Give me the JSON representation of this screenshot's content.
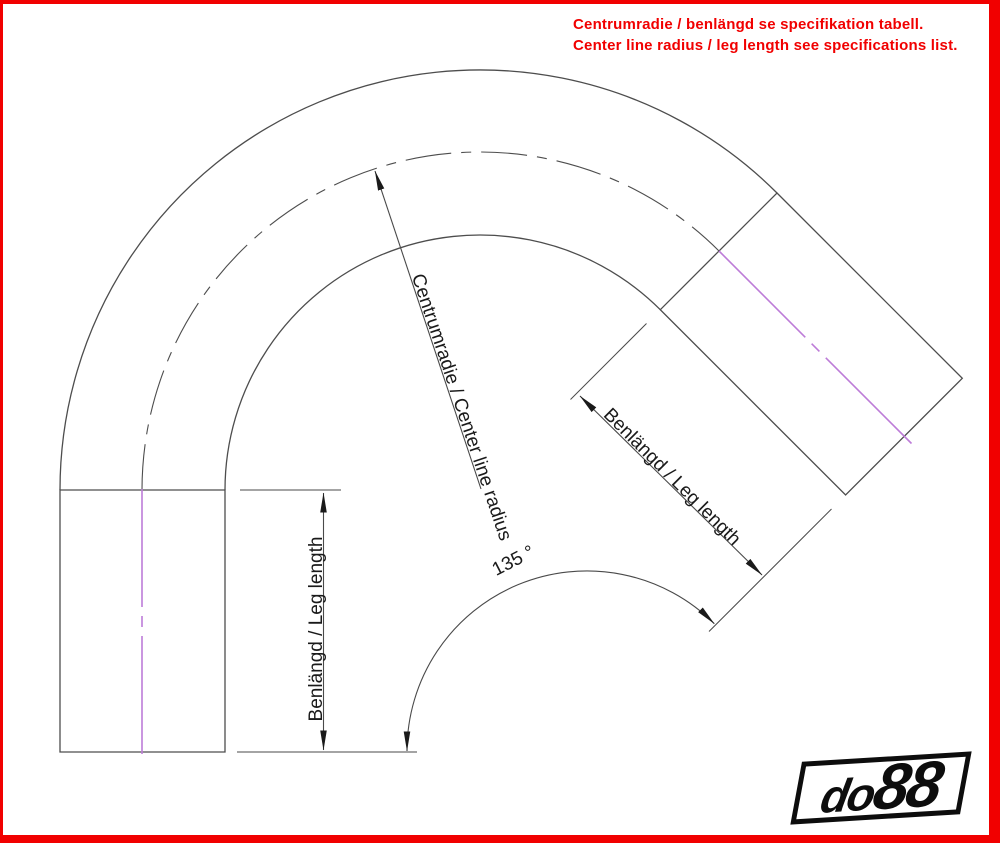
{
  "note": {
    "line1": "Centrumradie / benlängd se specifikation tabell.",
    "line2": "Center line radius / leg length see specifications list.",
    "color": "#f10000"
  },
  "diagram": {
    "type": "135-degree pipe bend technical drawing",
    "bend_angle_degrees": 135,
    "radius_label": "Centrumradie / Center line radius",
    "left_leg_label": "Benlängd / Leg length",
    "right_leg_label": "Benlängd / Leg length",
    "angle_label": "135 °",
    "colors": {
      "outline": "#4d4d4d",
      "centerline_purple": "#bd7cd8",
      "dimension": "#4a4a4a",
      "arrow": "#1a1a1a",
      "frame_red": "#f10000"
    }
  },
  "logo": {
    "prefix": "do",
    "suffix": "88"
  }
}
